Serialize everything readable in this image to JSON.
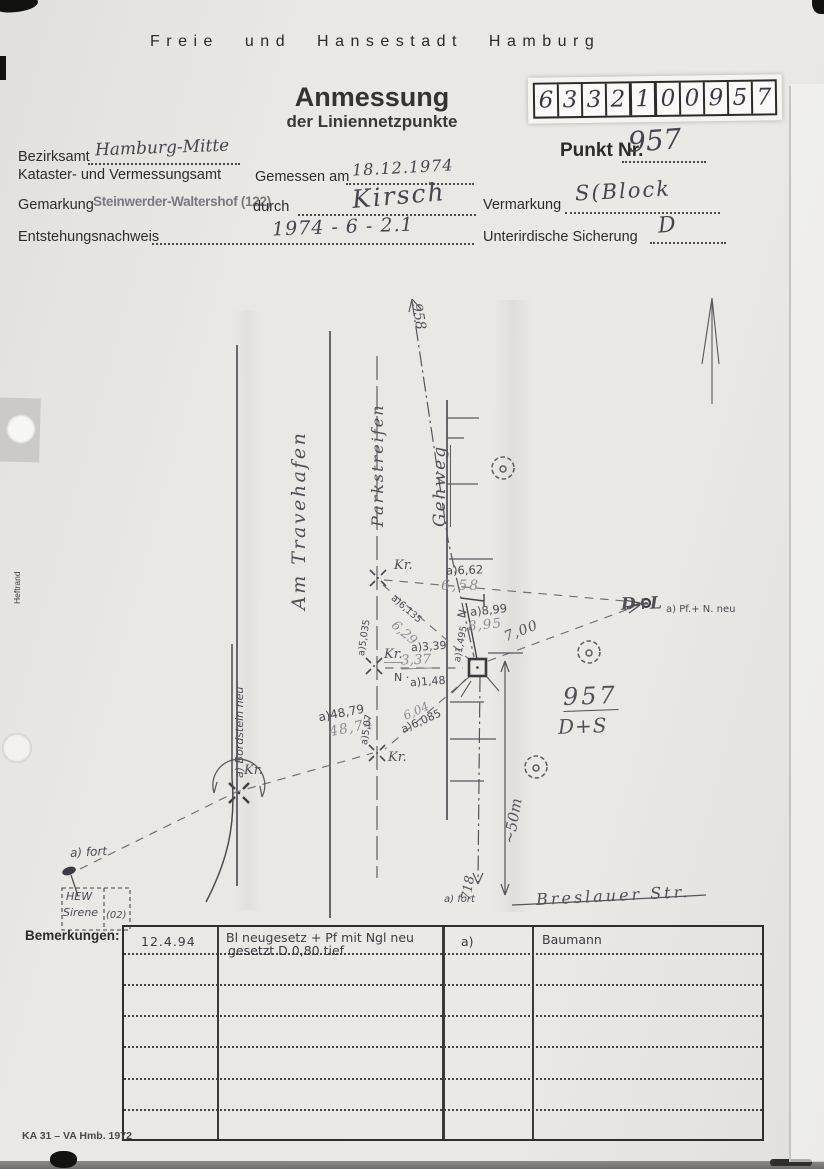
{
  "document": {
    "header": "Freie und Hansestadt Hamburg",
    "title": "Anmessung",
    "subtitle": "der Liniennetzpunkte",
    "footer_code": "KA 31 – VA Hmb. 1972",
    "margin_note": "Heftrand"
  },
  "point_id": {
    "digits": [
      "6",
      "3",
      "3",
      "2",
      "1",
      "0",
      "0",
      "9",
      "5",
      "7"
    ]
  },
  "fields": {
    "punkt_nr": {
      "label": "Punkt Nr.",
      "value": "957"
    },
    "bezirksamt": {
      "label": "Bezirksamt",
      "value": "Hamburg-Mitte"
    },
    "amt": {
      "label": "Kataster- und Vermessungsamt"
    },
    "gemessen": {
      "label": "Gemessen am",
      "value": "18.12.1974"
    },
    "gemarkung": {
      "label": "Gemarkung",
      "value": "Steinwerder-Waltershof (122)"
    },
    "durch": {
      "label": "durch",
      "value": "Kirsch"
    },
    "entstehung": {
      "label": "Entstehungsnachweis",
      "value": "1974 - 6 - 2.1"
    },
    "vermarkung": {
      "label": "Vermarkung",
      "value": "S(Block"
    },
    "sicherung": {
      "label": "Unterirdische Sicherung",
      "value": "D"
    }
  },
  "sketch": {
    "streets": {
      "travehafen": "Am Travehafen",
      "parkstreifen": "Parkstreifen",
      "gehweg": "Gehweg",
      "breslauer": "Breslauer Str."
    },
    "net_points": {
      "p958": "958",
      "p718": "718",
      "p957": "957",
      "p957_mark": "D+S",
      "dl": "D+L",
      "dl_note": "a) Pf.+ N. neu"
    },
    "annotations": {
      "bordstein": "a) Bordstein neu",
      "fort_left": "a) fort",
      "fort_bottom": "a) fort",
      "hew_line1": "HEW",
      "hew_line2": "Sirene",
      "hew_line3": "(02)",
      "approx50": "~50m",
      "kr": "Kr.",
      "n": "N",
      "n_dot": "N ·"
    },
    "measurements": {
      "m662_new": "a)6,62",
      "m662_old": "6,58",
      "m899_new": "a)8,99",
      "m899_old": "8,95",
      "m1495": "a)1,495",
      "m5035": "a)5,035",
      "m6135": "a)6,135",
      "m629_old": "6,29",
      "m339_new": "a)3,39",
      "m337_old": "3,37",
      "m148": "a)1,48",
      "m700": "7,00",
      "m4879_new": "a)48,79",
      "m4874_old": "48,74",
      "m507": "a)5,07",
      "m604_old": "6,04",
      "m6085_new": "a)6,085"
    }
  },
  "remarks": {
    "label": "Bemerkungen:",
    "rows": [
      {
        "date": "12.4.94",
        "line1": "Bl neugesetz + Pf mit Ngl neu",
        "line2": "gesetzt D 0,80 tief",
        "ref": "a)",
        "name": "Baumann"
      }
    ]
  },
  "colors": {
    "paper": "#eae8e4",
    "pencil": "#4b4a53",
    "pencil_light": "#8d8b94",
    "ink": "#45444f",
    "print": "#2c2b29"
  }
}
